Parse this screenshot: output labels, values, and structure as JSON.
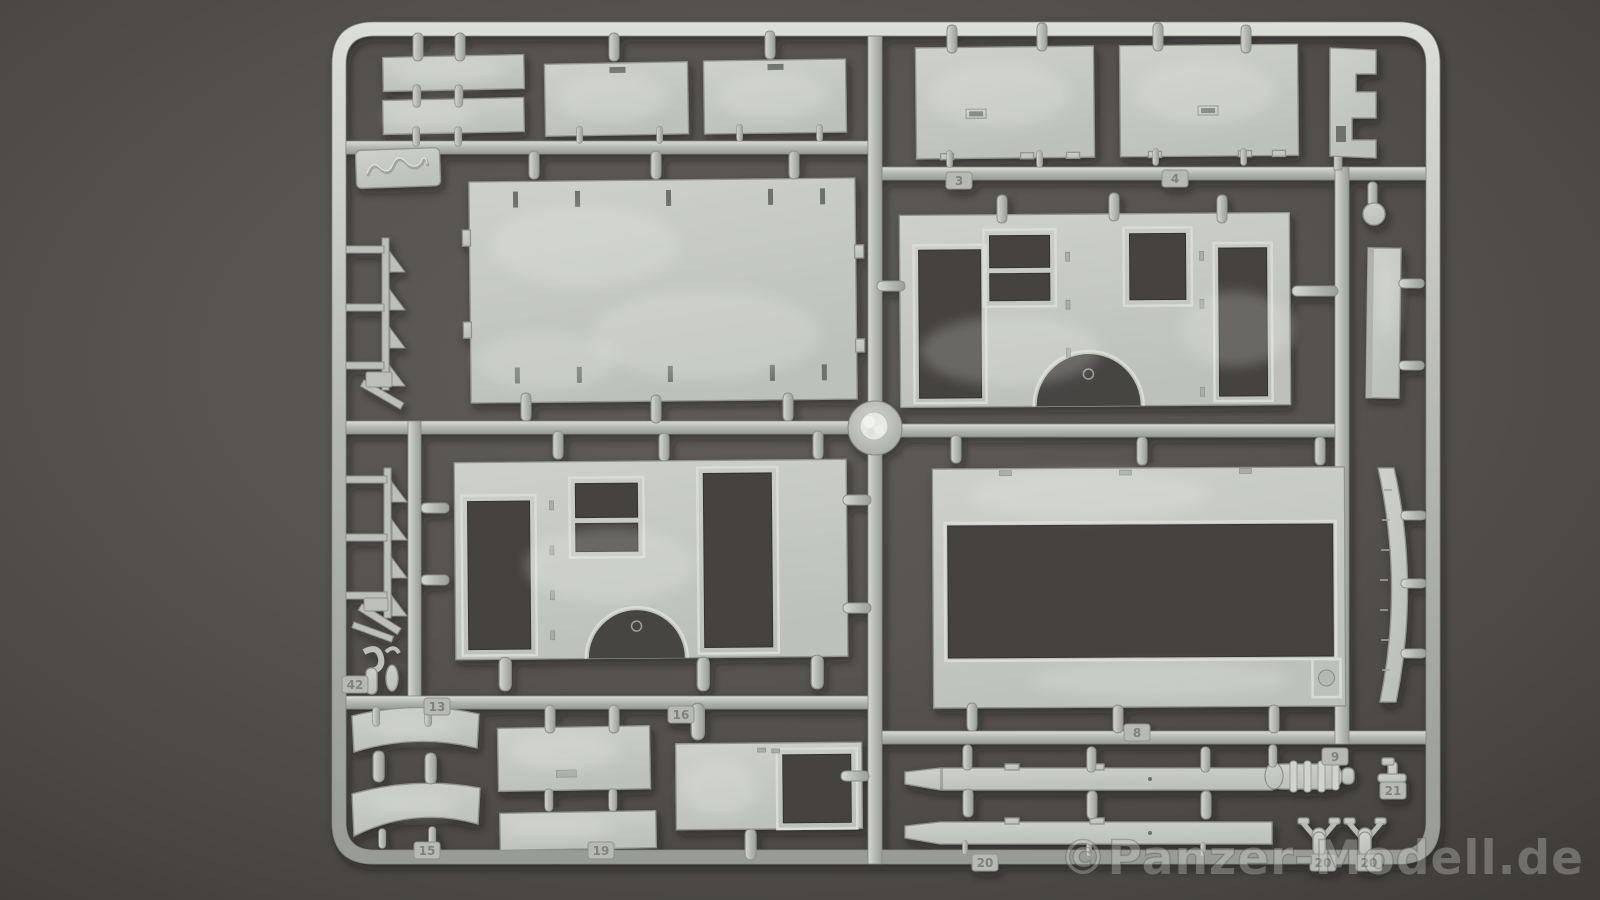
{
  "image": {
    "type": "photograph",
    "subject": "light grey injection-moulded plastic model kit sprue on dark grey backdrop",
    "width": 1600,
    "height": 900
  },
  "colors": {
    "background": "#56524e",
    "plastic": "#c5c9c2",
    "plastic_highlight": "#dfe2dc",
    "plastic_shadow": "#8f938d",
    "opening_shadow": "#45423f",
    "watermark": "#cdd0cb"
  },
  "watermark": {
    "text": "©Panzer-Modell.de"
  },
  "sprue": {
    "description": "Rectangular sprue frame with runners, holding wall panels with door and window openings, roof panels, hatches, fenders, chassis beams, ladders and small fittings; embossed manufacturer logo tab at upper left; round injection hub at centre.",
    "part_tags": [
      {
        "label": "3",
        "x": 946,
        "y": 172
      },
      {
        "label": "4",
        "x": 1162,
        "y": 170
      },
      {
        "label": "8",
        "x": 1124,
        "y": 724
      },
      {
        "label": "9",
        "x": 1322,
        "y": 748
      },
      {
        "label": "42",
        "x": 342,
        "y": 676
      },
      {
        "label": "13",
        "x": 424,
        "y": 698
      },
      {
        "label": "16",
        "x": 668,
        "y": 706
      },
      {
        "label": "15",
        "x": 414,
        "y": 842
      },
      {
        "label": "19",
        "x": 588,
        "y": 842
      },
      {
        "label": "20",
        "x": 972,
        "y": 854
      },
      {
        "label": "20",
        "x": 1310,
        "y": 854
      },
      {
        "label": "20",
        "x": 1356,
        "y": 854
      },
      {
        "label": "21",
        "x": 1380,
        "y": 782
      }
    ]
  }
}
